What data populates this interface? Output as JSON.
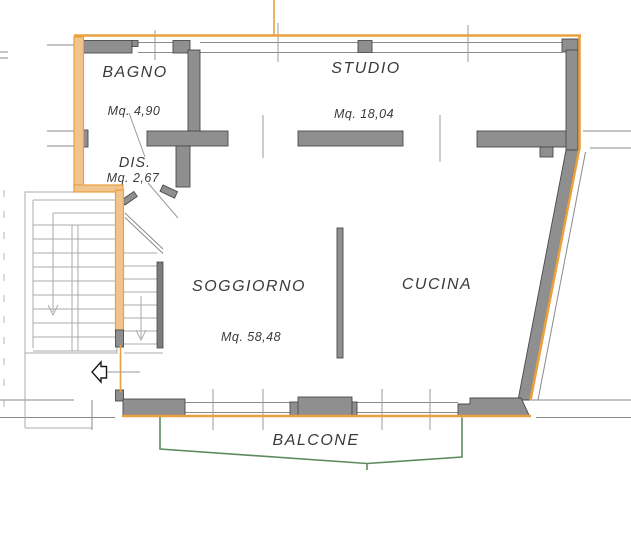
{
  "plan_labels": {
    "bagno": {
      "name": "BAGNO",
      "area": "Mq. 4,90"
    },
    "dis": {
      "name": "DIS.",
      "area": "Mq. 2,67"
    },
    "studio": {
      "name": "STUDIO",
      "area": "Mq. 18,04"
    },
    "soggiorno": {
      "name": "SOGGIORNO",
      "area": "Mq. 58,48"
    },
    "cucina": {
      "name": "CUCINA"
    },
    "balcone": {
      "name": "BALCONE"
    }
  },
  "colors": {
    "accent-orange": "#E8A13E",
    "wall-tan": "#F0C48E",
    "wall-gray": "#8F8F8F",
    "wall-stroke": "#4A4A4A",
    "line-gray": "#9B9B9B",
    "stair-gray": "#ABABAB",
    "balcony-green": "#5E8B5E",
    "text-color": "#3A3A3A"
  }
}
